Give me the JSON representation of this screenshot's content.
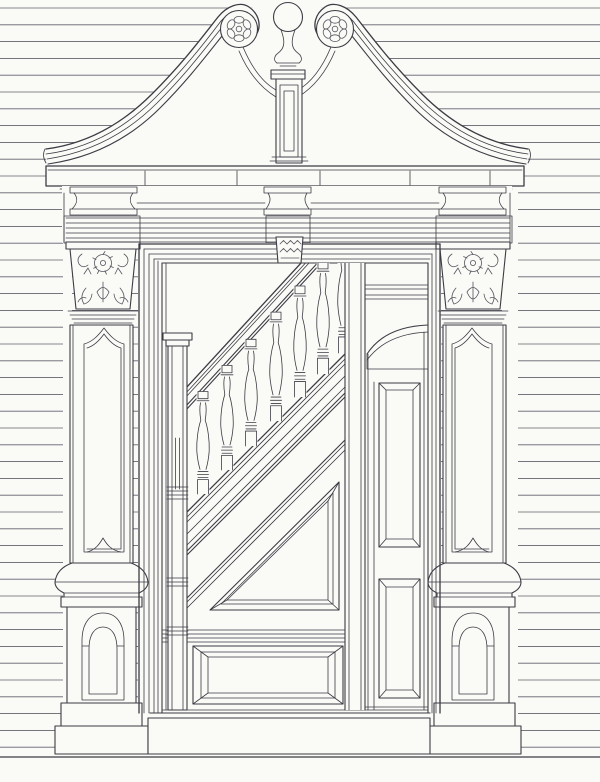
{
  "drawing": {
    "subject": "doorway-elevation-with-swan-neck-pediment-and-staircase",
    "style": "line-engraving"
  },
  "canvas": {
    "width": 600,
    "height": 782,
    "background": "#fafaf6"
  },
  "palette": {
    "ink": "#3c3c45",
    "ink_soft": "#55555f",
    "siding_line": "#62626c",
    "paper": "#fafaf6"
  },
  "siding": {
    "count": 45,
    "y_start": 8,
    "spacing": 16.8,
    "x1": 0,
    "x2": 600,
    "stroke_width": 0.85
  },
  "pediment": {
    "rosettes": [
      {
        "cx": 239,
        "cy": 29
      },
      {
        "cx": 335,
        "cy": 29
      }
    ],
    "rosette_outer_radius": 18.5,
    "rosette_eye_radius": 2.8,
    "petal_count": 6,
    "petal_radius": 9.2,
    "petal_rx": 5.0,
    "petal_ry": 3.4
  },
  "stair": {
    "balusters": [
      {
        "cx": 203,
        "top": 391.5,
        "bottom": 494
      },
      {
        "cx": 227,
        "top": 365.4,
        "bottom": 470
      },
      {
        "cx": 251,
        "top": 339.3,
        "bottom": 446
      },
      {
        "cx": 276,
        "top": 312.1,
        "bottom": 421
      },
      {
        "cx": 300,
        "top": 286.0,
        "bottom": 397
      },
      {
        "cx": 323,
        "top": 261.0,
        "bottom": 374
      },
      {
        "cx": 344,
        "top": 238.1,
        "bottom": 353
      }
    ]
  },
  "parts": [
    "swan-neck-scroll-pediment",
    "carved-rosette",
    "finial-urn-on-pedestal",
    "cornice-shelf",
    "frieze-console",
    "carved-keystone",
    "foliate-capital",
    "paneled-pilaster",
    "pedestal-base",
    "door-architrave",
    "newel-post",
    "turned-baluster",
    "handrail",
    "closed-string",
    "triangular-spandrel-panel",
    "dado-panel",
    "partition-stile",
    "arched-inner-door",
    "threshold-plinth"
  ]
}
